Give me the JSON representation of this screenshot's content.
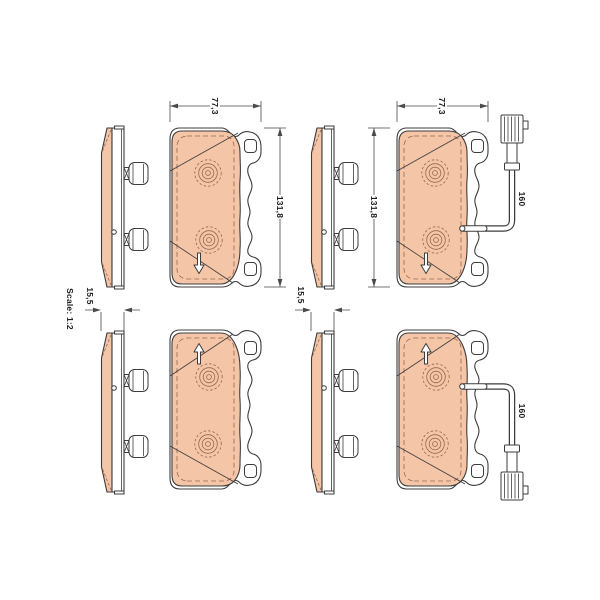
{
  "scale_note": "Scale: 1:2",
  "dim": {
    "width": "77,3",
    "height": "131,8",
    "thickness": "15,5",
    "sensor_length": "160"
  },
  "pads": [
    {
      "position": "top-left",
      "views": [
        "side",
        "front"
      ],
      "wear_sensor": false
    },
    {
      "position": "top-right",
      "views": [
        "side",
        "front"
      ],
      "wear_sensor": true
    },
    {
      "position": "bottom-left",
      "views": [
        "side",
        "front"
      ],
      "wear_sensor": false
    },
    {
      "position": "bottom-right",
      "views": [
        "side",
        "front"
      ],
      "wear_sensor": true
    }
  ],
  "colors": {
    "friction_material": "#f4c5a7",
    "outline": "#3d3d3d",
    "detail_lines": "#96674e",
    "dimension_lines": "#4a4a4a",
    "background": "#ffffff"
  }
}
